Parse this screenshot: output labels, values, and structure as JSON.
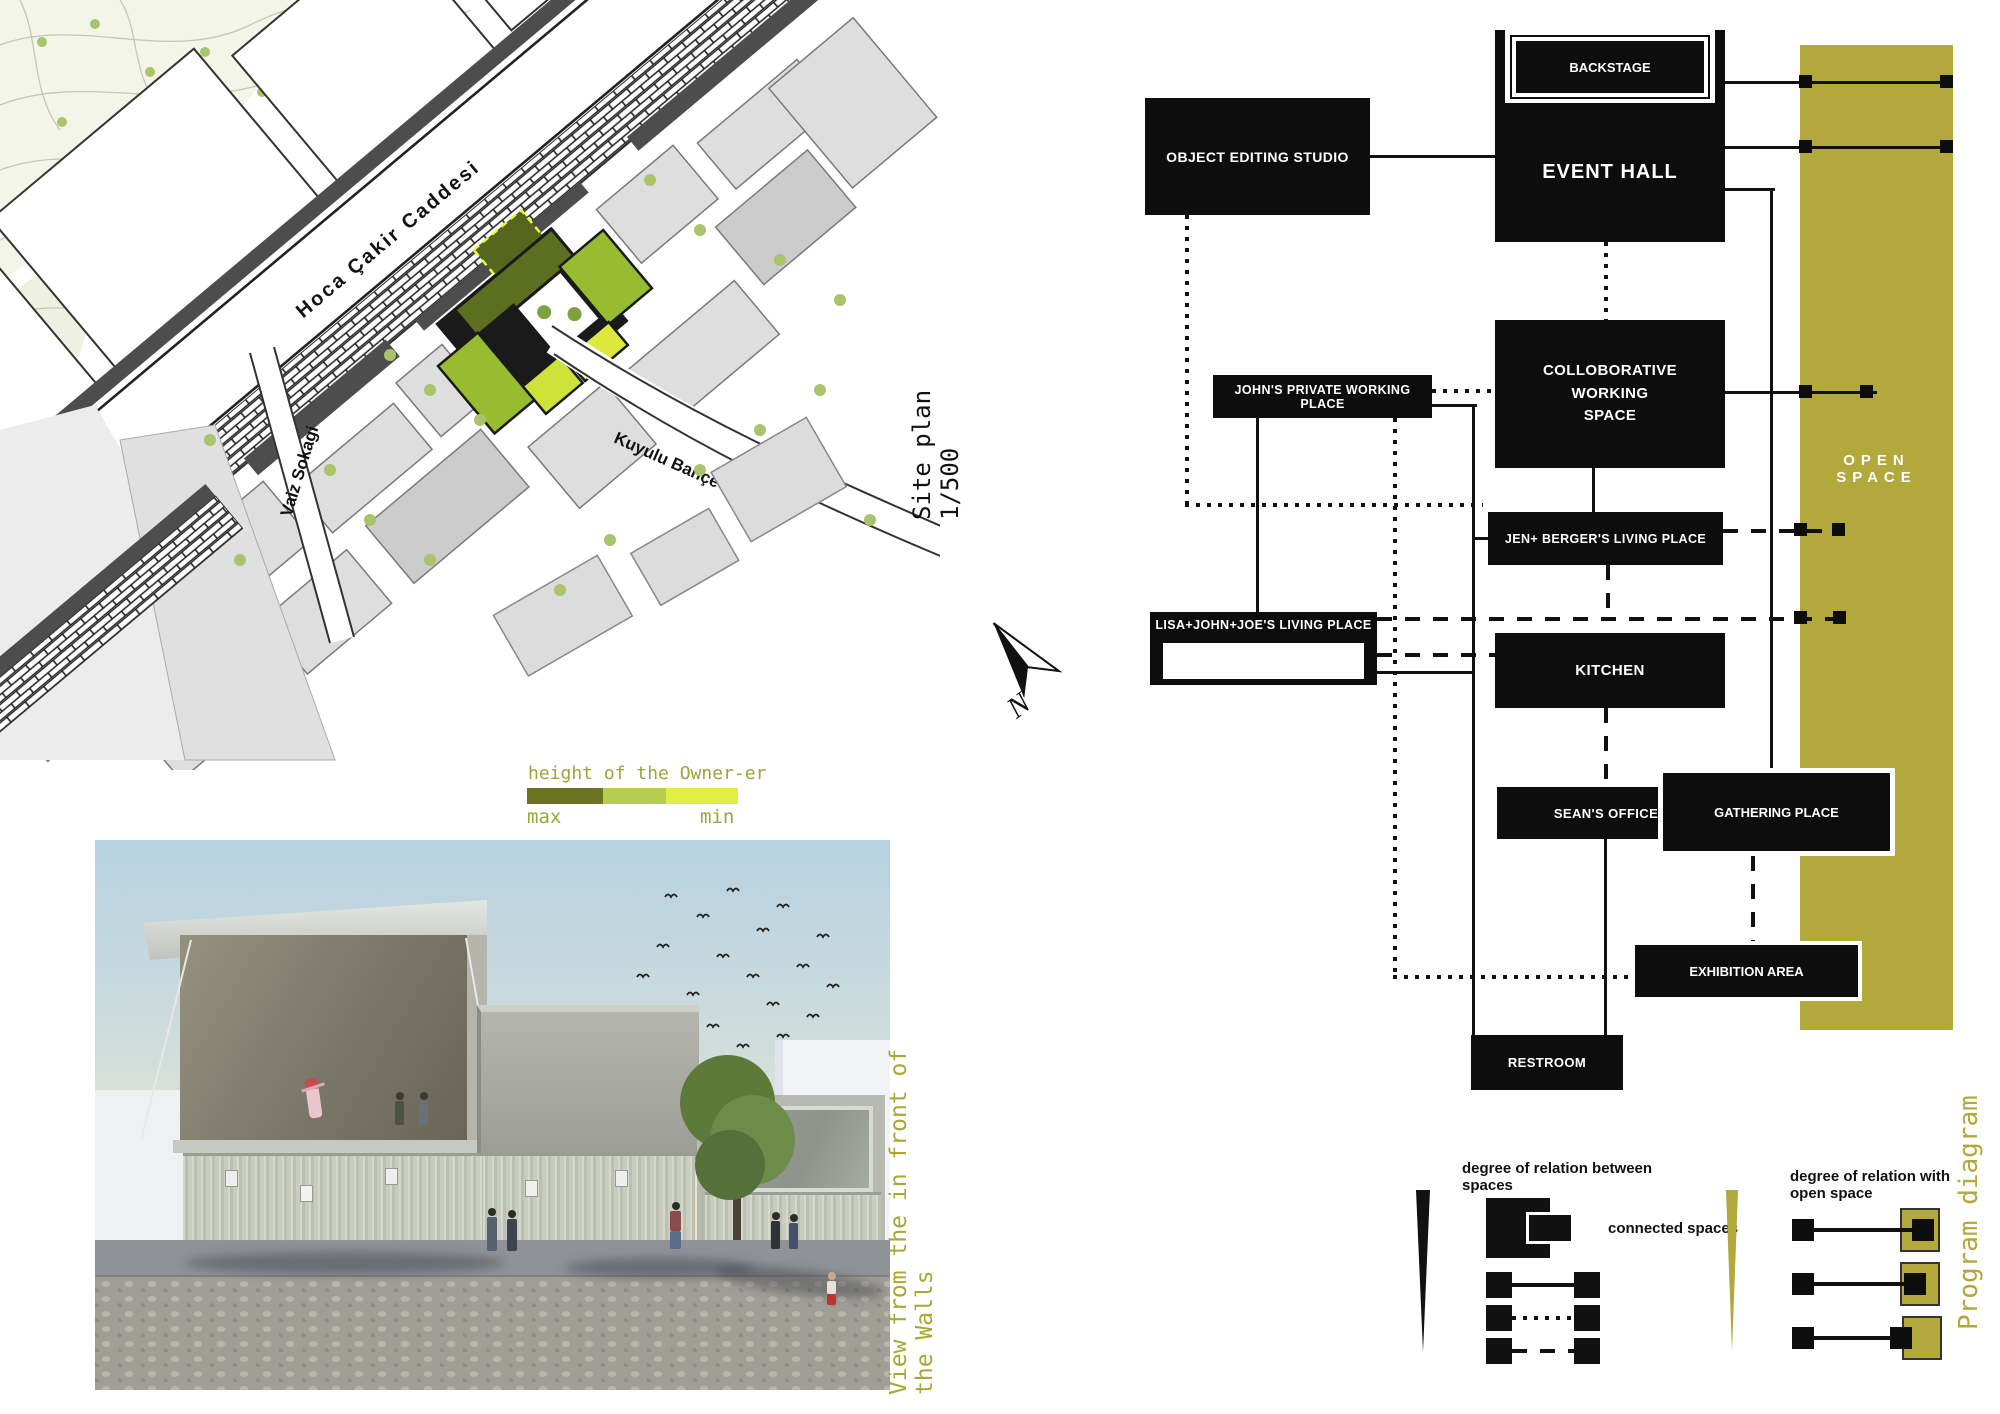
{
  "site_plan": {
    "caption": "Site plan 1/500",
    "north_label": "N",
    "streets": {
      "main": "Hoca Çakir Caddesi",
      "west": "Vaiz Sokagi",
      "south": "Kuyulu Bahçe Sokagi"
    }
  },
  "height_legend": {
    "title": "height of the Owner-er",
    "max_label": "max",
    "min_label": "min",
    "colors": [
      "#6b7323",
      "#b5cc51",
      "#e0ef47"
    ]
  },
  "render_view": {
    "caption": "View from the in front of the Walls"
  },
  "program_diagram": {
    "caption": "Program diagram",
    "accent_color": "#b3a83c",
    "open_space_label": "OPEN SPACE",
    "boxes": {
      "backstage": "BACKSTAGE",
      "event_hall": "EVENT HALL",
      "object_editing_studio": "OBJECT EDITING STUDIO",
      "colloborative_working_space": "COLLOBORATIVE\nWORKING\nSPACE",
      "johns_private_working_place": "JOHN'S PRIVATE WORKING PLACE",
      "jen_bergers_living_place": "JEN+ BERGER'S LIVING PLACE",
      "lisa_john_joes_living_place": "LISA+JOHN+JOE'S LIVING PLACE",
      "lisas_private_working_place": "LISA'S PRIVATE WORKING PLACE",
      "kitchen": "KITCHEN",
      "seans_office": "SEAN'S OFFICE",
      "gathering_place": "GATHERING PLACE",
      "exhibition_area": "EXHIBITION AREA",
      "restroom": "RESTROOM"
    },
    "legend_between_spaces": {
      "title": "degree of relation between spaces",
      "connected_label": "connected spaces"
    },
    "legend_open_space": {
      "title": "degree of relation with open space"
    }
  }
}
